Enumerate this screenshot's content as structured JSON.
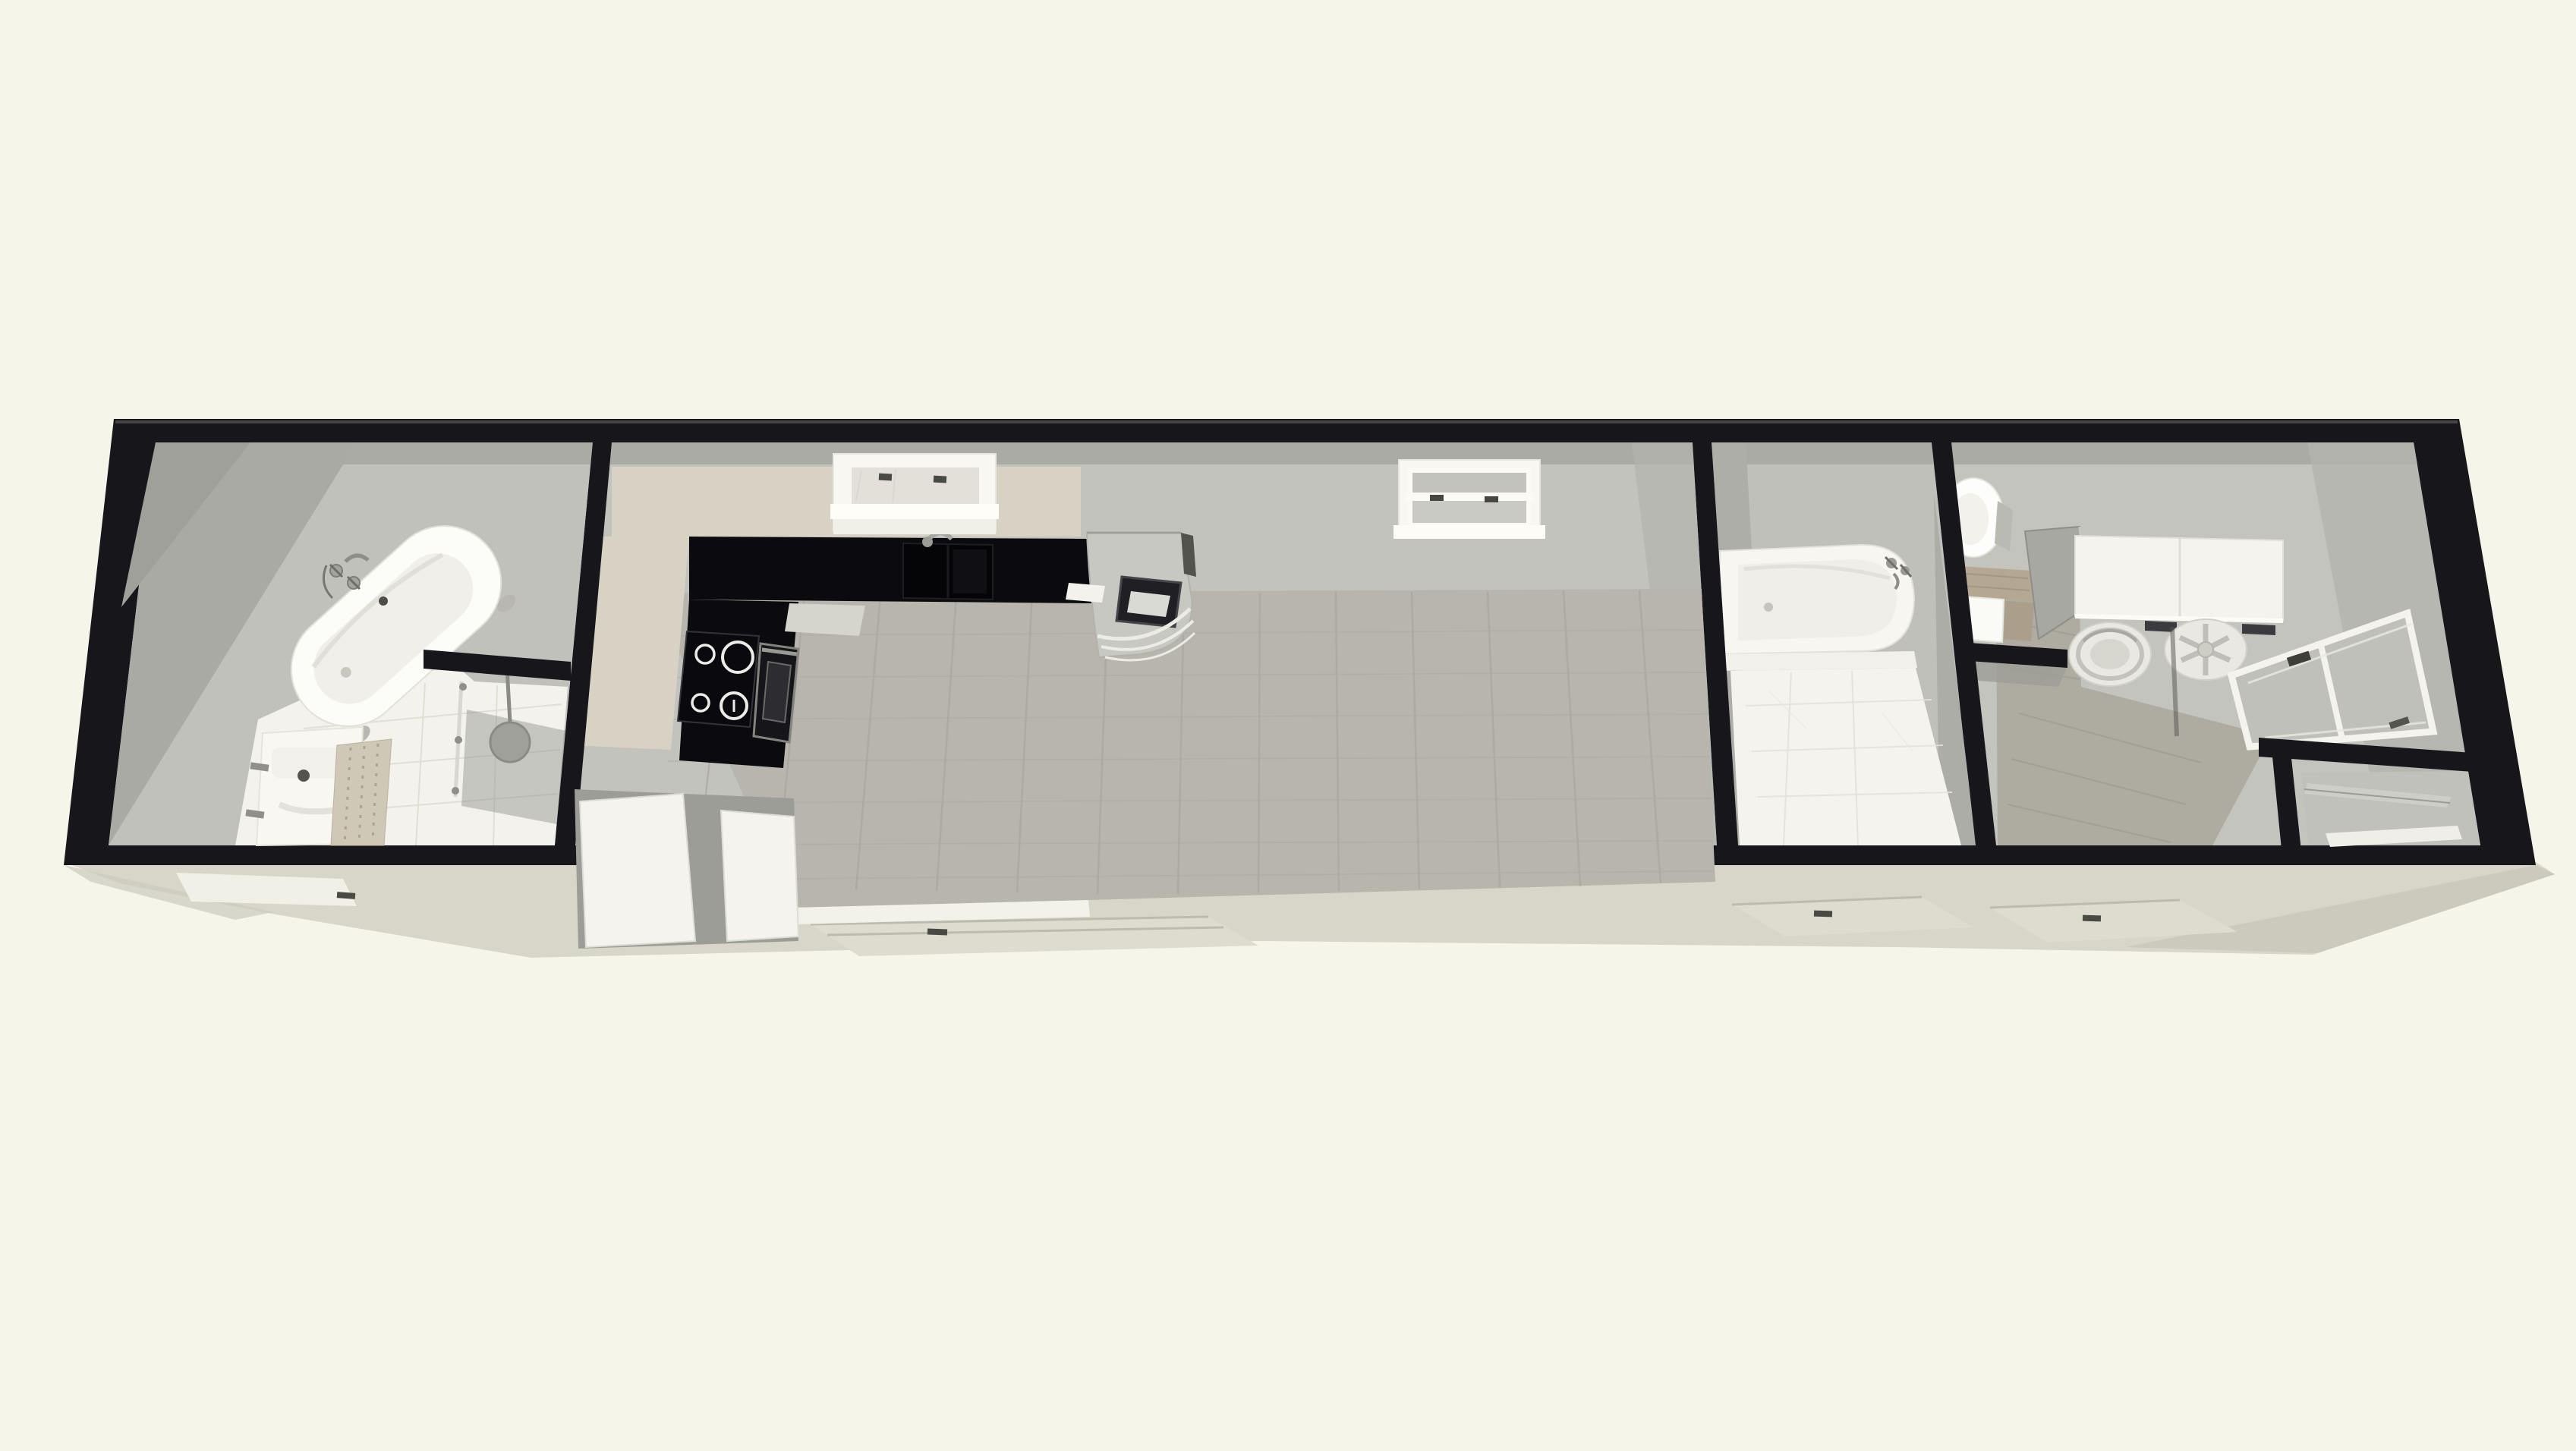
{
  "app": {
    "name": "floor-plan-3d-render",
    "view_mode": "3D aerial perspective",
    "content_type": "rendered floor plan of a long single-story home"
  },
  "palette": {
    "background": "#F6F5E9",
    "wall_outline": "#17171B",
    "wall_face": "#C2C3BD",
    "wall_face_dark": "#A9AAA4",
    "ceiling_strip": "#A8A9A3",
    "floor_wood": "#B7B5AC",
    "floor_wood_line": "#A7A59C",
    "laundry_wood": "#AEABA1",
    "tile_white": "#F3F2EC",
    "tile_line": "#DFDCD1",
    "counter_black": "#0B0B0F",
    "counter_beige": "#D8D2C4",
    "cabinet_white": "#F4F3EE",
    "fixture_white": "#FCFCF9",
    "chrome": "#9A9A94",
    "apron": "#D8D6C9",
    "apron_shadow": "#CCCABD",
    "ramp": "#DEDCCF",
    "warm_wood": "#CFC8B6"
  },
  "building": {
    "storeys": 1,
    "shape": "long narrow rectangle seen from the front-top",
    "walls": "thick black outline"
  },
  "rooms": [
    {
      "id": "main-bathroom",
      "label": "Bathroom",
      "fixtures": [
        "freestanding clawfoot bathtub",
        "floor mounted tub faucet",
        "vanity sink unit",
        "wood slat mat",
        "walk-in shower",
        "rain shower head",
        "glass shower screen",
        "white tile floor",
        "partial privacy wall"
      ]
    },
    {
      "id": "kitchen",
      "label": "Kitchen",
      "fixtures": [
        "L-shaped black countertop",
        "inset sink with faucet",
        "window above sink",
        "four burner cooktop",
        "wall oven",
        "curved corner cabinet with built-in oven display",
        "beige backsplash",
        "white base cabinets (cutaway)"
      ]
    },
    {
      "id": "living-room",
      "label": "Living room",
      "fixtures": [
        "wood plank floor",
        "double-hung window with handles"
      ]
    },
    {
      "id": "second-bathroom",
      "label": "Shower room",
      "fixtures": [
        "built-in bathtub with faucet",
        "tub apron",
        "white tile shower floor"
      ]
    },
    {
      "id": "laundry-room",
      "label": "Laundry / utility room",
      "fixtures": [
        "round toilet",
        "wood counter surround",
        "white sink cabinet",
        "gray partition panel",
        "wall cabinets",
        "washing machine (top view)",
        "dryer with spoked lid",
        "glazed double door",
        "entry vestibule with partial walls",
        "wood plank floor"
      ]
    }
  ],
  "exterior": {
    "elements": [
      "concrete apron slab",
      "entry ramp below kitchen",
      "entry ramp below shower room",
      "entry ramp below laundry",
      "white door thresholds",
      "small dark door handles"
    ]
  }
}
